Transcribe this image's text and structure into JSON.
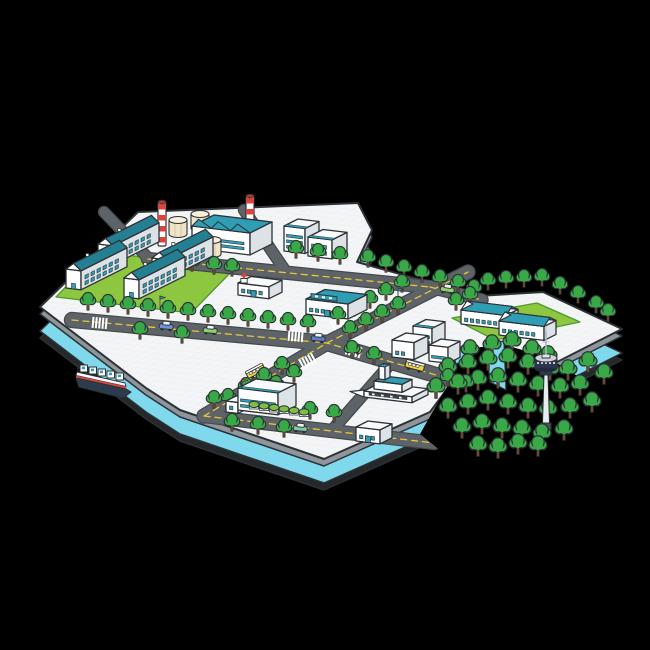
{
  "scene": {
    "kind": "isometric-city-island-illustration",
    "palette": {
      "bg": "#000000",
      "surface": "#f4f5f6",
      "grid": "#e9eaec",
      "outline": "#2c3136",
      "rim": "#8f969b",
      "water": "#7fd8eb",
      "under": "#24282b",
      "road": "#5d6367",
      "road_casing": "#43484c",
      "road_line": "#e8c73a",
      "crosswalk": "#ffffff",
      "grass": "#8dc63f",
      "grass_line": "#4f9934",
      "tree": "#39a847",
      "tree_dark": "#156329",
      "trunk": "#7a4c2b",
      "bfront": "#ffffff",
      "bside": "#dde2e6",
      "btop": "#f7f9fa",
      "teal": "#2f9db3",
      "teal_dark": "#247f92",
      "cream": "#efe4c6",
      "cream_top": "#f7efd9",
      "red": "#d8453c",
      "navy": "#2b3552",
      "navy_dark": "#1f2840",
      "steel": "#e9edf0",
      "gray": "#aeb6bc",
      "hull": "#2c3c4e",
      "hedge": "#7bc043",
      "car_blue": "#6f92d8",
      "car_navy": "#5d7fc8",
      "car_lime": "#8fd16e",
      "car_teal": "#7fc9a8",
      "bus_yellow": "#f3d23b"
    },
    "island": {
      "top": [
        [
          40,
          307
        ],
        [
          138,
          212
        ],
        [
          358,
          203
        ],
        [
          372,
          230
        ],
        [
          357,
          262
        ],
        [
          478,
          296
        ],
        [
          543,
          292
        ],
        [
          622,
          329
        ],
        [
          557,
          362
        ],
        [
          507,
          351
        ],
        [
          470,
          358
        ],
        [
          430,
          412
        ],
        [
          324,
          459
        ],
        [
          180,
          410
        ],
        [
          146,
          388
        ]
      ],
      "rim_drop": 7,
      "water_drop": 24,
      "under_drop": 31
    },
    "mountain": [
      [
        452,
        352
      ],
      [
        470,
        348
      ],
      [
        505,
        345
      ],
      [
        540,
        355
      ],
      [
        558,
        364
      ],
      [
        600,
        390
      ],
      [
        616,
        418
      ],
      [
        566,
        450
      ],
      [
        510,
        468
      ],
      [
        452,
        460
      ],
      [
        420,
        434
      ],
      [
        436,
        406
      ],
      [
        452,
        378
      ]
    ],
    "river": [
      [
        [
          452,
          350
        ],
        [
          470,
          344
        ],
        [
          474,
          358
        ],
        [
          456,
          364
        ]
      ],
      [
        [
          486,
          344
        ],
        [
          504,
          341
        ],
        [
          506,
          390
        ],
        [
          490,
          382
        ]
      ]
    ],
    "lawns": [
      {
        "name": "apartment-lawn",
        "pts": [
          [
            56,
            297
          ],
          [
            100,
            252
          ],
          [
            235,
            268
          ],
          [
            191,
            313
          ]
        ]
      },
      {
        "name": "school-lawn",
        "pts": [
          [
            452,
            318
          ],
          [
            537,
            303
          ],
          [
            580,
            322
          ],
          [
            495,
            340
          ]
        ]
      }
    ],
    "roads": [
      {
        "name": "north-road",
        "pts": [
          [
            148,
            259
          ],
          [
            430,
            287
          ]
        ],
        "w": 12,
        "dash": true
      },
      {
        "name": "coast-road",
        "pts": [
          [
            430,
            287
          ],
          [
            482,
            300
          ]
        ],
        "w": 11,
        "dash": true
      },
      {
        "name": "main-avenue",
        "pts": [
          [
            72,
            320
          ],
          [
            327,
            343
          ],
          [
            480,
            388
          ]
        ],
        "w": 14,
        "dash": true
      },
      {
        "name": "south-road",
        "pts": [
          [
            204,
            416
          ],
          [
            434,
            443
          ]
        ],
        "w": 12,
        "dash": true
      },
      {
        "name": "cross-street",
        "pts": [
          [
            204,
            416
          ],
          [
            327,
            343
          ],
          [
            468,
            272
          ]
        ],
        "w": 13,
        "dash": true
      },
      {
        "name": "terminal-street",
        "pts": [
          [
            334,
            428
          ],
          [
            392,
            362
          ]
        ],
        "w": 10,
        "dash": false
      },
      {
        "name": "factory-street-east",
        "pts": [
          [
            244,
            210
          ],
          [
            284,
            269
          ]
        ],
        "w": 10,
        "dash": false
      },
      {
        "name": "factory-street-west",
        "pts": [
          [
            104,
            212
          ],
          [
            150,
            260
          ]
        ],
        "w": 10,
        "dash": false
      }
    ],
    "crosswalks": [
      {
        "x": 296,
        "y": 336,
        "rot": 5
      },
      {
        "x": 354,
        "y": 351,
        "rot": 16
      },
      {
        "x": 339,
        "y": 322,
        "rot": -28
      },
      {
        "x": 308,
        "y": 361,
        "rot": -28
      },
      {
        "x": 100,
        "y": 323,
        "rot": 5
      }
    ],
    "buildings": [
      {
        "name": "apartment-block-1",
        "type": "apartment",
        "x": 98,
        "y": 263,
        "wa": 15,
        "wb": 46,
        "h": 19
      },
      {
        "name": "apartment-block-2",
        "type": "apartment",
        "x": 152,
        "y": 277,
        "wa": 15,
        "wb": 46,
        "h": 19
      },
      {
        "name": "apartment-block-3",
        "type": "apartment",
        "x": 66,
        "y": 288,
        "wa": 15,
        "wb": 46,
        "h": 19
      },
      {
        "name": "apartment-block-4",
        "type": "apartment",
        "x": 124,
        "y": 297,
        "wa": 15,
        "wb": 46,
        "h": 19
      },
      {
        "name": "office-tower-1",
        "type": "box",
        "x": 284,
        "y": 251,
        "wa": 21,
        "wb": 14,
        "h": 25,
        "windows": "stripes",
        "roofBand": true
      },
      {
        "name": "office-tower-2",
        "type": "box",
        "x": 308,
        "y": 256,
        "wa": 24,
        "wb": 15,
        "h": 19,
        "windows": "grid",
        "roofBand": true
      },
      {
        "name": "clinic",
        "type": "box",
        "x": 238,
        "y": 295,
        "wa": 31,
        "wb": 13,
        "h": 12,
        "windows": "grid",
        "door": true,
        "cross": true
      },
      {
        "name": "market-hall",
        "type": "box",
        "x": 306,
        "y": 314,
        "wa": 42,
        "wb": 19,
        "h": 15,
        "windows": "grid",
        "roof": "teal",
        "sign": true,
        "door": true
      },
      {
        "name": "office-block-a",
        "type": "box",
        "x": 392,
        "y": 357,
        "wa": 22,
        "wb": 14,
        "h": 17,
        "windows": "grid"
      },
      {
        "name": "office-block-b",
        "type": "box",
        "x": 413,
        "y": 351,
        "wa": 19,
        "wb": 13,
        "h": 25,
        "windows": "stripes",
        "roofBand": true
      },
      {
        "name": "office-block-c",
        "type": "box",
        "x": 429,
        "y": 361,
        "wa": 19,
        "wb": 12,
        "h": 16,
        "windows": "stripes"
      },
      {
        "name": "school-building-1",
        "type": "longhouse",
        "x": 461,
        "y": 324,
        "wa": 45,
        "wb": 12,
        "h": 14,
        "windows": "grid"
      },
      {
        "name": "school-building-2",
        "type": "longhouse",
        "x": 499,
        "y": 335,
        "wa": 45,
        "wb": 12,
        "h": 14,
        "windows": "grid"
      },
      {
        "name": "hospital",
        "type": "box",
        "x": 238,
        "y": 410,
        "wa": 40,
        "wb": 18,
        "h": 22,
        "windows": "stripes",
        "roofBand": true,
        "flag": true
      },
      {
        "name": "hospital-wing",
        "type": "box",
        "x": 226,
        "y": 412,
        "wa": 12,
        "wb": 10,
        "h": 11,
        "windows": "grid"
      },
      {
        "name": "corner-shop",
        "type": "box",
        "x": 356,
        "y": 441,
        "wa": 24,
        "wb": 12,
        "h": 14,
        "windows": "grid",
        "door": true
      }
    ],
    "factory": {
      "hall": {
        "x": 192,
        "y": 248,
        "wa": 58,
        "wb": 22,
        "h": 22
      },
      "chimneys": [
        [
          162,
          246
        ],
        [
          250,
          240
        ]
      ],
      "tanks": [
        [
          178,
          234
        ],
        [
          200,
          228
        ],
        [
          212,
          254
        ]
      ]
    },
    "terminal": {
      "x": 364,
      "y": 397
    },
    "tower": {
      "x": 546,
      "y": 430
    },
    "ship": {
      "x": 76,
      "y": 372
    },
    "trees": [
      [
        88,
        310
      ],
      [
        108,
        312
      ],
      [
        128,
        314
      ],
      [
        148,
        316
      ],
      [
        168,
        318
      ],
      [
        188,
        320
      ],
      [
        208,
        322
      ],
      [
        228,
        324
      ],
      [
        248,
        326
      ],
      [
        268,
        328
      ],
      [
        288,
        330
      ],
      [
        308,
        332
      ],
      [
        140,
        339
      ],
      [
        182,
        343
      ],
      [
        170,
        269
      ],
      [
        192,
        271
      ],
      [
        214,
        274
      ],
      [
        232,
        276
      ],
      [
        296,
        258
      ],
      [
        318,
        261
      ],
      [
        340,
        264
      ],
      [
        368,
        267
      ],
      [
        386,
        272
      ],
      [
        404,
        277
      ],
      [
        422,
        282
      ],
      [
        440,
        287
      ],
      [
        458,
        292
      ],
      [
        474,
        297
      ],
      [
        338,
        324
      ],
      [
        354,
        316
      ],
      [
        370,
        308
      ],
      [
        386,
        300
      ],
      [
        402,
        292
      ],
      [
        350,
        338
      ],
      [
        366,
        330
      ],
      [
        382,
        322
      ],
      [
        398,
        314
      ],
      [
        282,
        374
      ],
      [
        264,
        385
      ],
      [
        246,
        395
      ],
      [
        228,
        406
      ],
      [
        294,
        382
      ],
      [
        276,
        393
      ],
      [
        258,
        403
      ],
      [
        214,
        408
      ],
      [
        310,
        419
      ],
      [
        334,
        422
      ],
      [
        232,
        431
      ],
      [
        258,
        434
      ],
      [
        284,
        437
      ],
      [
        352,
        358
      ],
      [
        374,
        364
      ],
      [
        448,
        386
      ],
      [
        466,
        392
      ],
      [
        488,
        290
      ],
      [
        506,
        288
      ],
      [
        524,
        287
      ],
      [
        542,
        286
      ],
      [
        560,
        294
      ],
      [
        578,
        303
      ],
      [
        596,
        313
      ],
      [
        608,
        321
      ],
      [
        456,
        310
      ],
      [
        470,
        304
      ]
    ],
    "forest": [
      [
        470,
        360
      ],
      [
        492,
        355
      ],
      [
        512,
        352
      ],
      [
        532,
        360
      ],
      [
        548,
        366
      ],
      [
        448,
        378
      ],
      [
        468,
        374
      ],
      [
        488,
        370
      ],
      [
        508,
        368
      ],
      [
        528,
        374
      ],
      [
        550,
        380
      ],
      [
        568,
        380
      ],
      [
        436,
        398
      ],
      [
        458,
        394
      ],
      [
        478,
        390
      ],
      [
        498,
        388
      ],
      [
        518,
        392
      ],
      [
        538,
        396
      ],
      [
        560,
        398
      ],
      [
        580,
        395
      ],
      [
        448,
        418
      ],
      [
        468,
        414
      ],
      [
        488,
        410
      ],
      [
        508,
        414
      ],
      [
        528,
        418
      ],
      [
        548,
        420
      ],
      [
        570,
        418
      ],
      [
        592,
        412
      ],
      [
        462,
        438
      ],
      [
        482,
        434
      ],
      [
        502,
        438
      ],
      [
        522,
        440
      ],
      [
        542,
        444
      ],
      [
        564,
        440
      ],
      [
        478,
        456
      ],
      [
        498,
        458
      ],
      [
        518,
        454
      ],
      [
        538,
        456
      ],
      [
        588,
        372
      ],
      [
        604,
        384
      ]
    ],
    "hedges": [
      [
        254,
        408
      ],
      [
        264,
        409.5
      ],
      [
        274,
        411
      ],
      [
        284,
        412.5
      ],
      [
        294,
        414
      ],
      [
        304,
        415.5
      ]
    ],
    "poles": [
      [
        332,
        314
      ],
      [
        252,
        292
      ],
      [
        160,
        308
      ],
      [
        398,
        300
      ]
    ],
    "vehicles": [
      {
        "name": "car-blue",
        "kind": "car",
        "color": "car_blue",
        "x": 166,
        "y": 329,
        "rot": 5
      },
      {
        "name": "car-lime",
        "kind": "car",
        "color": "car_lime",
        "x": 210,
        "y": 333,
        "rot": 5
      },
      {
        "name": "car-navy",
        "kind": "car",
        "color": "car_navy",
        "x": 318,
        "y": 341,
        "rot": 5
      },
      {
        "name": "car-lime-2",
        "kind": "car",
        "color": "car_lime",
        "x": 354,
        "y": 352,
        "rot": 15
      },
      {
        "name": "minibus-yellow",
        "kind": "bus",
        "color": "bus_yellow",
        "x": 414,
        "y": 369,
        "rot": 15
      },
      {
        "name": "minibus-yellow-2",
        "kind": "bus",
        "color": "bus_yellow",
        "x": 257,
        "y": 374,
        "rot": -28
      },
      {
        "name": "car-lime-3",
        "kind": "car",
        "color": "car_lime",
        "x": 447,
        "y": 292,
        "rot": 8
      },
      {
        "name": "car-teal",
        "kind": "car",
        "color": "car_teal",
        "x": 300,
        "y": 431,
        "rot": 6
      }
    ]
  }
}
